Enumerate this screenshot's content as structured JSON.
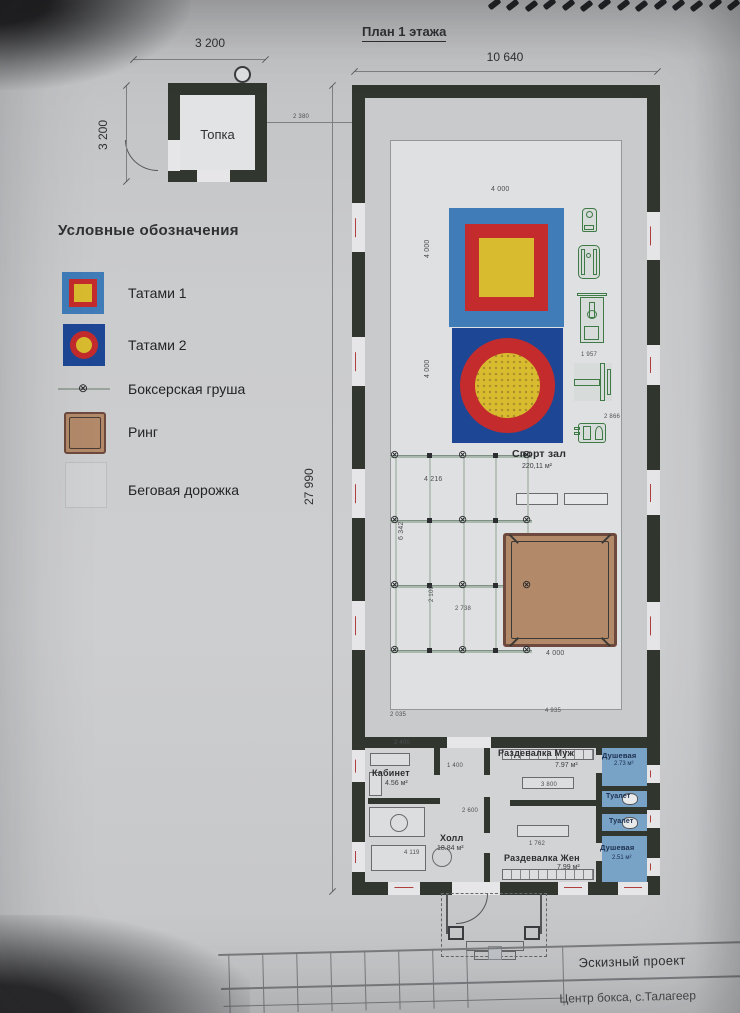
{
  "plan": {
    "title": "План 1 этажа",
    "width_dim": "10 640",
    "height_dim": "27 990",
    "hall": {
      "name": "Спорт зал",
      "area": "220,11 м²"
    },
    "rooms": [
      {
        "name": "Кабинет",
        "area": "4.56 м²"
      },
      {
        "name": "Холл",
        "area": "18.84 м²"
      },
      {
        "name": "Раздевалка Муж",
        "area": "7.97 м²"
      },
      {
        "name": "Раздевалка Жен",
        "area": "7.99 м²"
      },
      {
        "name": "Душевая",
        "area": "2.73 м²"
      },
      {
        "name": "Туалет",
        "area": ""
      },
      {
        "name": "Туалет",
        "area": ""
      },
      {
        "name": "Душевая",
        "area": "2.51 м²"
      }
    ]
  },
  "boiler": {
    "name": "Топка",
    "width_dim": "3 200",
    "height_dim": "3 200"
  },
  "legend": {
    "heading": "Условные обозначения",
    "items": [
      {
        "label": "Татами 1"
      },
      {
        "label": "Татами 2"
      },
      {
        "label": "Боксерская груша"
      },
      {
        "label": "Ринг"
      },
      {
        "label": "Беговая дорожка"
      }
    ]
  },
  "title_block": {
    "type": "Эскизный проект",
    "object": "Центр бокса, с.Талагеер"
  },
  "icons": {
    "bag": "⊗"
  },
  "dims": [
    {
      "text": "2 380",
      "x": 293,
      "y": 114,
      "r": 0,
      "s": 6
    },
    {
      "text": "4 000",
      "x": 491,
      "y": 186,
      "r": 0,
      "s": 7
    },
    {
      "text": "4 000",
      "x": 424,
      "y": 258,
      "r": -90,
      "s": 7
    },
    {
      "text": "4 000",
      "x": 424,
      "y": 378,
      "r": -90,
      "s": 7
    },
    {
      "text": "1 957",
      "x": 581,
      "y": 352,
      "r": 0,
      "s": 6
    },
    {
      "text": "2 866",
      "x": 604,
      "y": 414,
      "r": 0,
      "s": 6
    },
    {
      "text": "4 216",
      "x": 424,
      "y": 476,
      "r": 0,
      "s": 7
    },
    {
      "text": "6 342",
      "x": 398,
      "y": 540,
      "r": -90,
      "s": 7
    },
    {
      "text": "2 100",
      "x": 429,
      "y": 602,
      "r": -90,
      "s": 6
    },
    {
      "text": "2 738",
      "x": 455,
      "y": 606,
      "r": 0,
      "s": 6
    },
    {
      "text": "4 000",
      "x": 546,
      "y": 650,
      "r": 0,
      "s": 7
    },
    {
      "text": "2 035",
      "x": 390,
      "y": 712,
      "r": 0,
      "s": 6
    },
    {
      "text": "4 935",
      "x": 545,
      "y": 708,
      "r": 0,
      "s": 6
    },
    {
      "text": "2 400",
      "x": 394,
      "y": 740,
      "r": 0,
      "s": 6
    },
    {
      "text": "1 400",
      "x": 447,
      "y": 763,
      "r": 0,
      "s": 6
    },
    {
      "text": "3 800",
      "x": 541,
      "y": 782,
      "r": 0,
      "s": 6
    },
    {
      "text": "2 600",
      "x": 462,
      "y": 808,
      "r": 0,
      "s": 6
    },
    {
      "text": "4 119",
      "x": 404,
      "y": 850,
      "r": 0,
      "s": 6
    },
    {
      "text": "1 762",
      "x": 529,
      "y": 841,
      "r": 0,
      "s": 6
    }
  ],
  "colors": {
    "wall": "#31362f",
    "hall": "#dfe0e2",
    "track": "#c9cacc",
    "rooms_floor": "#d2d3d5",
    "tatami1_blue": "#3f7cb8",
    "tatami2_navy": "#1d4795",
    "mat_red": "#c32b2c",
    "mat_yellow": "#d9bb2f",
    "ring_tan": "#b28a6a",
    "ring_border": "#6d4a3d",
    "wet_blue": "#78a2c6",
    "equip_green": "#3e7a45",
    "line": "#7e7f81",
    "text_dark": "#2f3032"
  }
}
